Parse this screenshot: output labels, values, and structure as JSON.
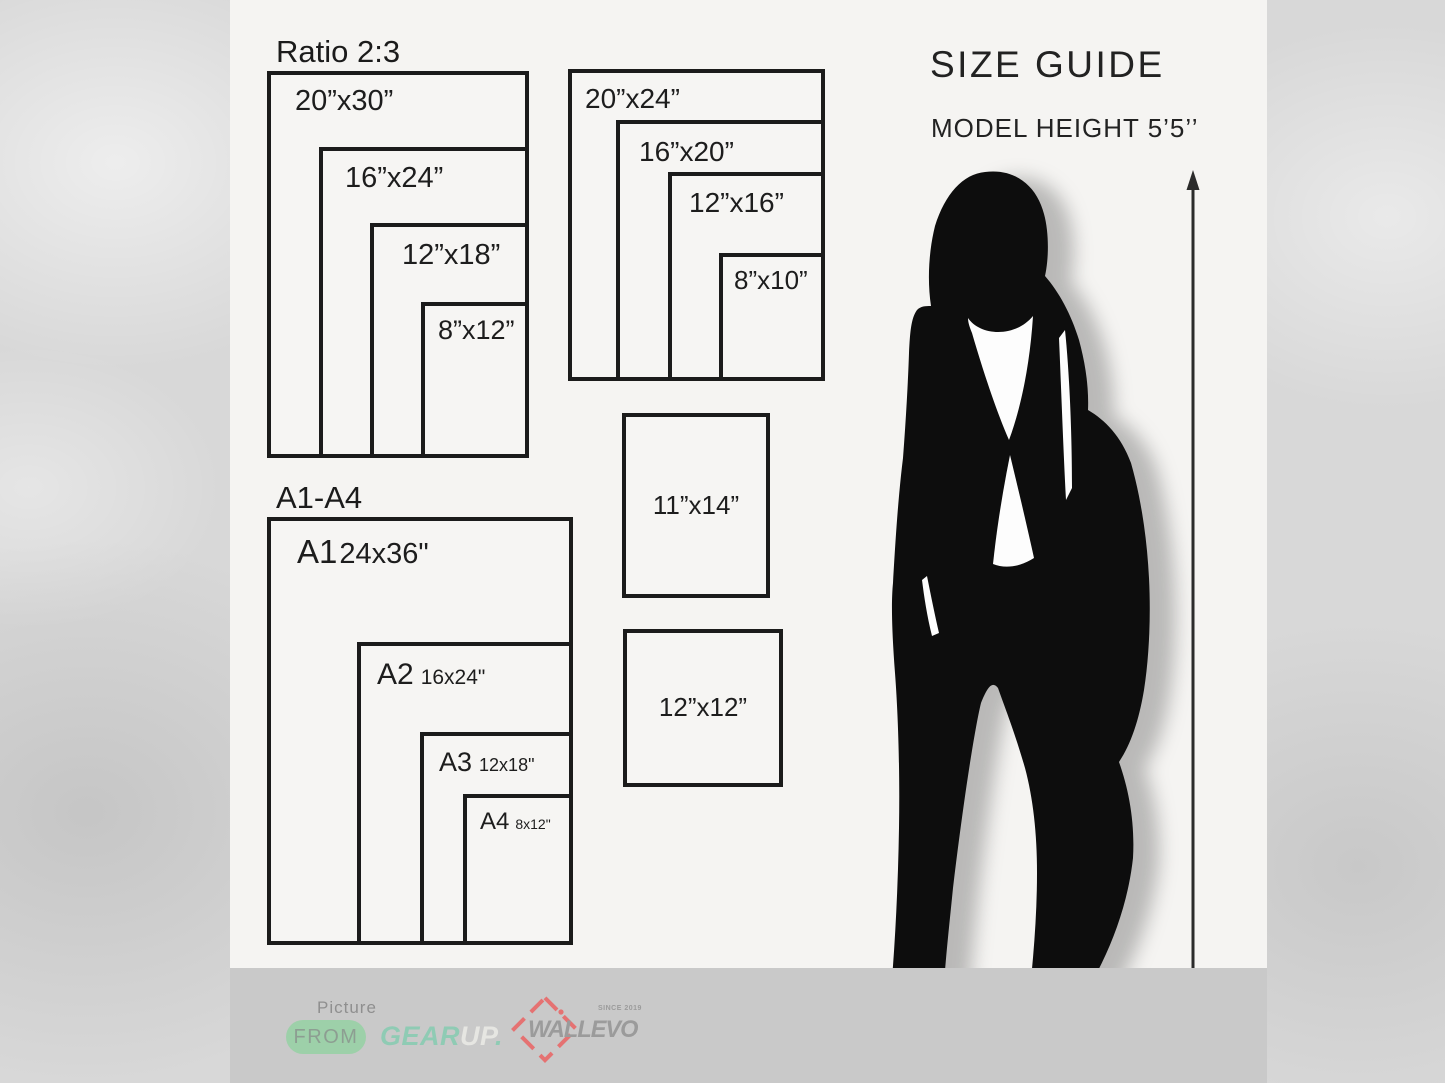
{
  "size_guide": {
    "title": "SIZE GUIDE",
    "model_height": "MODEL HEIGHT 5’5’’"
  },
  "ratio_group": {
    "title": "Ratio 2:3",
    "frames": [
      "20”x30”",
      "16”x24”",
      "12”x18”",
      "8”x12”"
    ]
  },
  "standard_group": {
    "frames": [
      "20”x24”",
      "16”x20”",
      "12”x16”",
      "8”x10”"
    ]
  },
  "single_frames": [
    "11”x14”",
    "12”x12”"
  ],
  "a_series_group": {
    "title": "A1-A4",
    "frames": [
      {
        "name": "A1",
        "size": "24x36\""
      },
      {
        "name": "A2",
        "size": "16x24\""
      },
      {
        "name": "A3",
        "size": "12x18\""
      },
      {
        "name": "A4",
        "size": "8x12\""
      }
    ]
  },
  "footer": {
    "picture_label": "Picture",
    "from_badge": "FROM",
    "gearup": {
      "gear": "GEAR",
      "up": "UP",
      "dot": "."
    },
    "wallevo": {
      "name": "WALLEVO",
      "tagline": "SINCE 2019"
    }
  },
  "colors": {
    "ink": "#1b1b1b",
    "panel_bg": "#f5f4f2",
    "outer_bg": "#d8d8d8",
    "footer_bg": "#c9c9c9",
    "mint_pill": "#9dd0a9",
    "gear_mint": "#8fcbb4",
    "up_light": "#e6e6e2",
    "logo_gray": "#9b9b9b",
    "diamond_red": "#e57272"
  }
}
